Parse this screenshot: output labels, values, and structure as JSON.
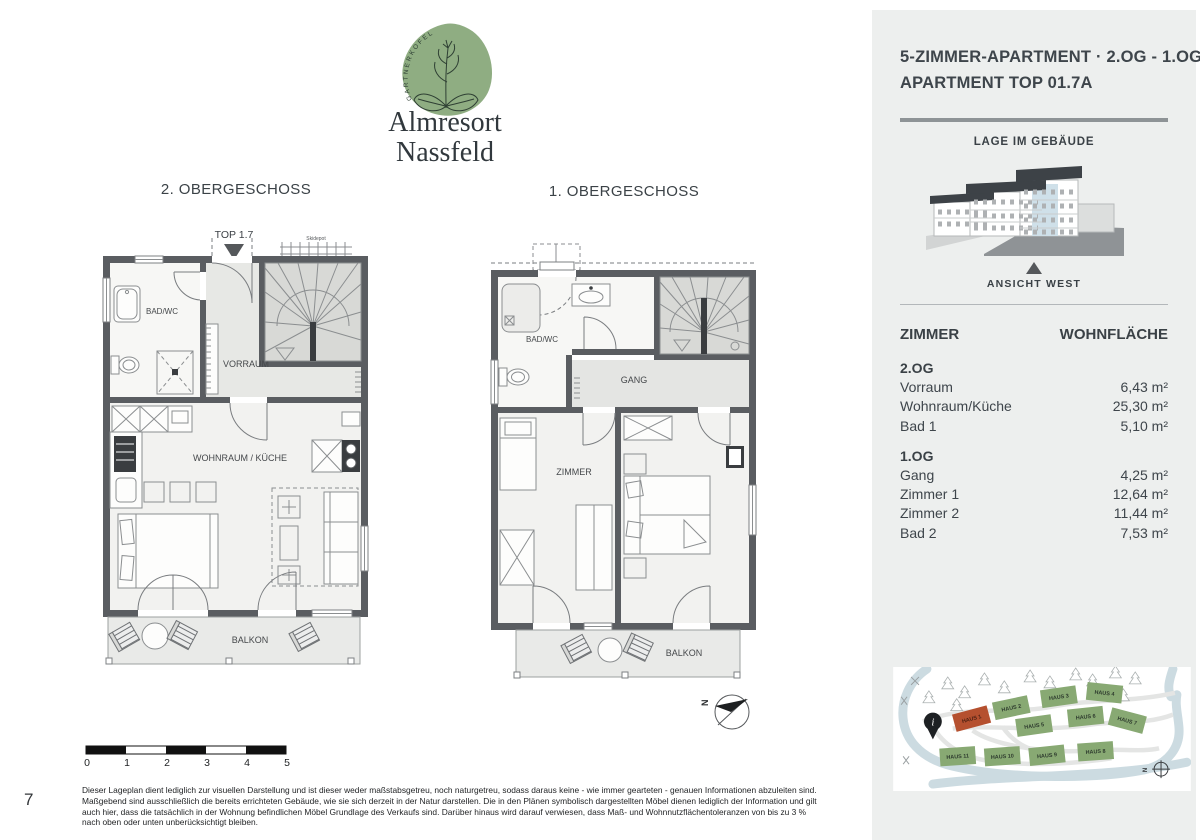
{
  "page": {
    "number": "7"
  },
  "logo": {
    "badge_text": "GARTNERKOFEL",
    "name_line1": "Almresort",
    "name_line2": "Nassfeld"
  },
  "plans": {
    "left": {
      "title": "2. OBERGESCHOSS",
      "top_label": "TOP 1.7",
      "ski_label": "Skidepot",
      "rooms": {
        "bath": "BAD/WC",
        "hall": "VORRAUM",
        "living": "WOHNRAUM / KÜCHE",
        "balcony": "BALKON"
      }
    },
    "right": {
      "title": "1. OBERGESCHOSS",
      "rooms": {
        "bath": "BAD/WC",
        "hall": "GANG",
        "room1": "ZIMMER",
        "room2": "ZIMMER",
        "balcony": "BALKON"
      }
    },
    "compass_label": "N"
  },
  "scalebar": {
    "ticks": [
      "0",
      "1",
      "2",
      "3",
      "4",
      "5"
    ]
  },
  "disclaimer": "Dieser Lageplan dient lediglich zur visuellen Darstellung und ist dieser weder maßstabsgetreu, noch naturgetreu, sodass daraus keine - wie immer gearteten - genauen Informationen abzuleiten sind. Maßgebend sind ausschließlich die bereits errichteten Gebäude, wie sie sich derzeit in der Natur darstellen. Die in den Plänen symbolisch dargestellten Möbel dienen lediglich der Information und gilt auch hier, dass die tatsächlich in der Wohnung befindlichen Möbel Grundlage des Verkaufs sind. Darüber hinaus wird darauf verwiesen, dass Maß- und Wohnnutzflächentoleranzen von bis zu 3 % nach oben oder unten unberücksichtigt bleiben.",
  "sidebar": {
    "title_line1": "5-ZIMMER-APARTMENT · 2.OG - 1.OG",
    "title_line2": "APARTMENT TOP 01.7A",
    "location_heading": "LAGE IM GEBÄUDE",
    "view_label": "ANSICHT WEST",
    "table": {
      "col_room": "ZIMMER",
      "col_area": "WOHNFLÄCHE",
      "sections": [
        {
          "label": "2.OG",
          "rows": [
            [
              "Vorraum",
              "6,43 m²"
            ],
            [
              "Wohnraum/Küche",
              "25,30 m²"
            ],
            [
              "Bad 1",
              "5,10 m²"
            ]
          ]
        },
        {
          "label": "1.OG",
          "rows": [
            [
              "Gang",
              "4,25 m²"
            ],
            [
              "Zimmer 1",
              "12,64 m²"
            ],
            [
              "Zimmer 2",
              "11,44 m²"
            ],
            [
              "Bad 2",
              "7,53 m²"
            ]
          ]
        }
      ]
    },
    "sitemap": {
      "houses": [
        "HAUS 1",
        "HAUS 2",
        "HAUS 3",
        "HAUS 4",
        "HAUS 5",
        "HAUS 6",
        "HAUS 7",
        "HAUS 8",
        "HAUS 9",
        "HAUS 10",
        "HAUS 11"
      ],
      "north_label": "N"
    }
  },
  "colors": {
    "panel_bg": "#edefee",
    "logo_green": "#8fad82",
    "wall_gray": "#5a5d61",
    "house_green": "#88a973",
    "house_red": "#b5502f",
    "highlight_blue": "#cfe0e9"
  }
}
